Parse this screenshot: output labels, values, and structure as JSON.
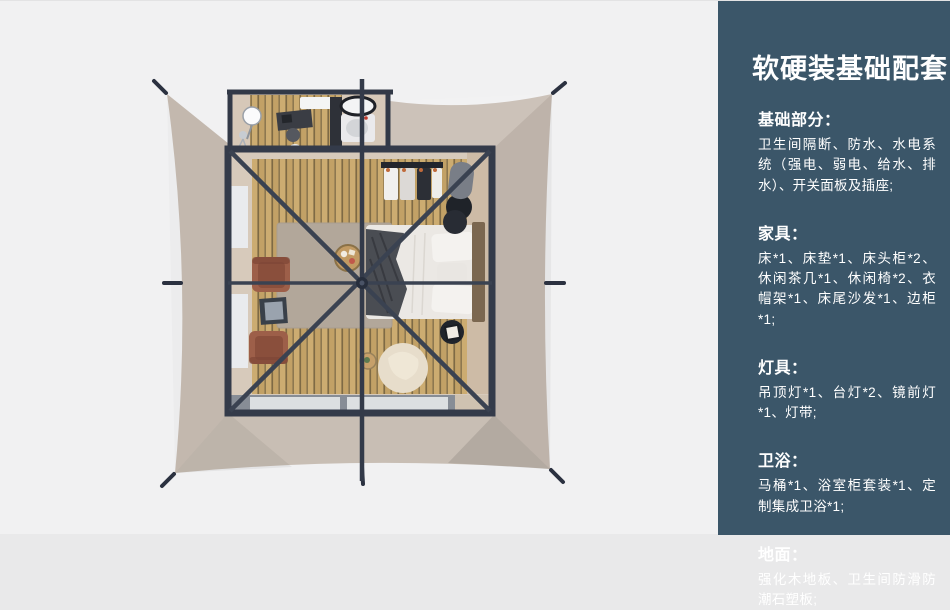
{
  "panel": {
    "title": "软硬装基础配套",
    "sections": [
      {
        "heading": "基础部分：",
        "body": "卫生间隔断、防水、水电系统（强电、弱电、给水、排水）、开关面板及插座;"
      },
      {
        "heading": "家具：",
        "body": "床*1、床垫*1、床头柜*2、休闲茶几*1、休闲椅*2、衣帽架*1、床尾沙发*1、边柜*1;"
      },
      {
        "heading": "灯具：",
        "body": "吊顶灯*1、台灯*2、镜前灯*1、灯带;"
      },
      {
        "heading": "卫浴：",
        "body": "马桶*1、浴室柜套装*1、定制集成卫浴*1;"
      },
      {
        "heading": "地面：",
        "body": "强化木地板、卫生间防滑防潮石塑板;"
      }
    ]
  },
  "illustration": {
    "description": "top-down render of a square glamping tent with bedroom and bathroom",
    "colors": {
      "page_bg": "#f1f1f2",
      "panel_bg": "#3b5669",
      "tent_canvas": "#c7bcb2",
      "frame_dark": "#343b4a",
      "wood_floor": "#c2a166",
      "rug": "#b2a79a",
      "bedding": "#ebe8e4",
      "armchair": "#9d5f49",
      "bean_bag": "#e7ddcb"
    }
  }
}
